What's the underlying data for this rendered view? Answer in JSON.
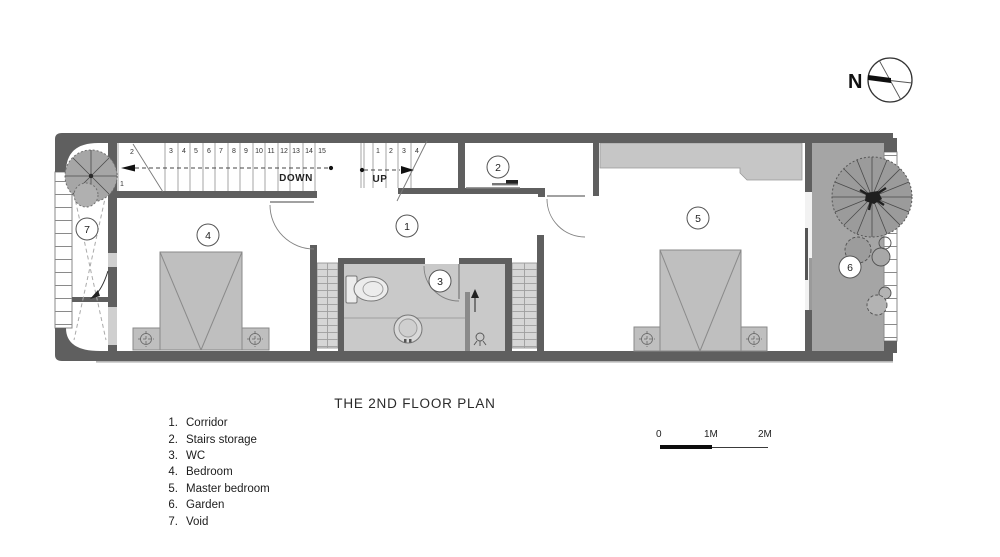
{
  "compass": {
    "label": "N"
  },
  "plan": {
    "title": "THE 2ND FLOOR PLAN",
    "room_labels": {
      "corridor": "1",
      "stairs_storage": "2",
      "wc": "3",
      "bedroom": "4",
      "master_bedroom": "5",
      "garden": "6",
      "void": "7"
    },
    "stairs": {
      "down": {
        "label": "DOWN",
        "numbers": [
          "1",
          "2",
          "3",
          "4",
          "5",
          "6",
          "7",
          "8",
          "9",
          "10",
          "11",
          "12",
          "13",
          "14",
          "15"
        ]
      },
      "up": {
        "label": "UP",
        "numbers": [
          "1",
          "2",
          "3",
          "4"
        ]
      }
    }
  },
  "legend": {
    "items": [
      {
        "num": "1.",
        "label": "Corridor"
      },
      {
        "num": "2.",
        "label": "Stairs storage"
      },
      {
        "num": "3.",
        "label": "WC"
      },
      {
        "num": "4.",
        "label": "Bedroom"
      },
      {
        "num": "5.",
        "label": "Master bedroom"
      },
      {
        "num": "6.",
        "label": "Garden"
      },
      {
        "num": "7.",
        "label": "Void"
      }
    ]
  },
  "scale_bar": {
    "labels": [
      "0",
      "1M",
      "2M"
    ]
  },
  "colors": {
    "wall": "#5f5f5f",
    "garden": "#a5a5a5",
    "wc_floor": "#c9c9c9",
    "furniture": "#bfbfbf",
    "wardrobe": "#c6c6c6",
    "strip": "#d6d6d6"
  }
}
